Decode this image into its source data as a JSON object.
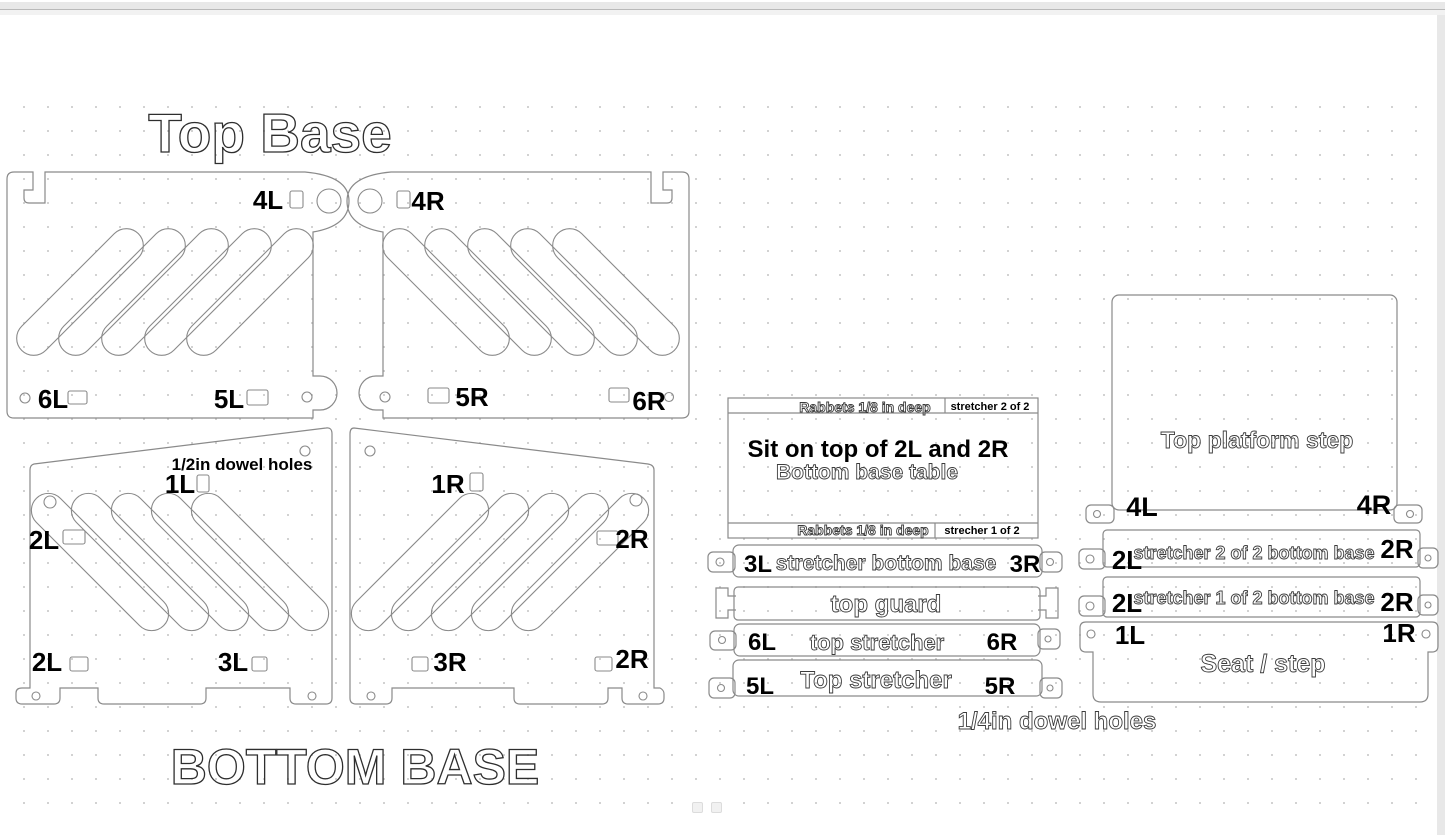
{
  "headings": {
    "top_base": "Top Base",
    "bottom_base": "BOTTOM BASE",
    "half_dowel": "1/2in dowel holes",
    "quarter_dowel": "1/4in dowel holes"
  },
  "panels": {
    "top_left": {
      "corner": "4L",
      "bottom_left": "6L",
      "bottom_right": "5L"
    },
    "top_right": {
      "corner": "4R",
      "bottom_left": "5R",
      "bottom_right": "6R"
    },
    "bottom_left": {
      "top": "1L",
      "side_upper": "2L",
      "side_lower": "2L",
      "bottom": "3L"
    },
    "bottom_right": {
      "top": "1R",
      "side_upper": "2R",
      "side_lower": "2R",
      "bottom": "3R"
    }
  },
  "table_piece": {
    "rabbets_top": "Rabbets 1/8 in deep",
    "stretcher_top": "stretcher 2 of 2",
    "line1": "Sit on top of 2L and 2R",
    "line2": "Bottom base table",
    "rabbets_bottom": "Rabbets 1/8 in deep",
    "stretcher_bottom": "strecher 1 of 2"
  },
  "middle_bars": {
    "bar1": {
      "left": "3L",
      "name": "stretcher bottom base",
      "right": "3R"
    },
    "bar2": {
      "name": "top guard"
    },
    "bar3": {
      "left": "6L",
      "name": "top stretcher",
      "right": "6R"
    },
    "bar4": {
      "left": "5L",
      "name": "Top stretcher",
      "right": "5R"
    }
  },
  "right_column": {
    "platform": {
      "name": "Top platform step",
      "left": "4L",
      "right": "4R"
    },
    "barA": {
      "left": "2L",
      "name": "stretcher 2 of 2 bottom base",
      "right": "2R"
    },
    "barB": {
      "left": "2L",
      "name": "stretcher 1 of 2 bottom base",
      "right": "2R"
    },
    "seat": {
      "left": "1L",
      "right": "1R",
      "name": "Seat / step"
    }
  }
}
